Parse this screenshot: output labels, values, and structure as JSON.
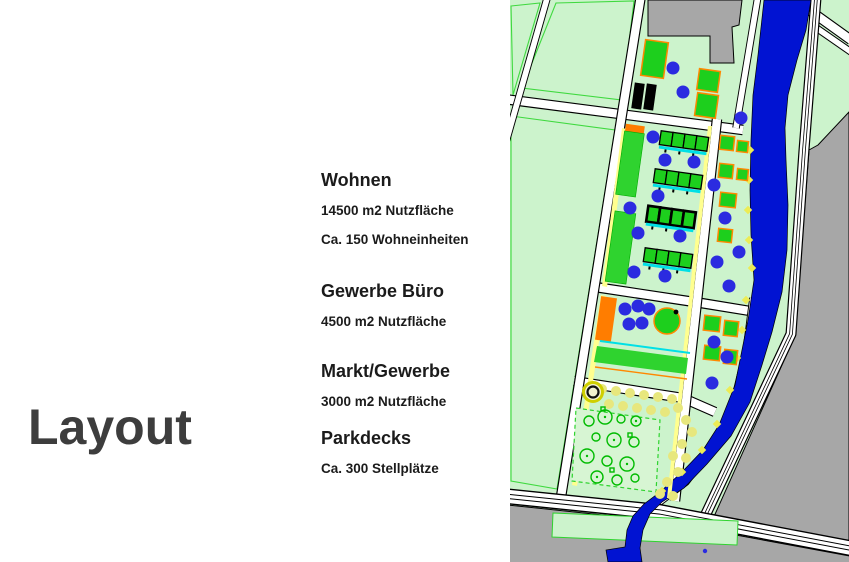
{
  "slide": {
    "title": "Layout",
    "sections": [
      {
        "heading": "Wohnen",
        "lines": [
          "14500 m2 Nutzfläche",
          "Ca. 150 Wohneinheiten"
        ]
      },
      {
        "heading": "Gewerbe Büro",
        "lines": [
          "4500 m2 Nutzfläche"
        ]
      },
      {
        "heading": "Markt/Gewerbe",
        "lines": [
          "3000 m2 Nutzfläche"
        ]
      },
      {
        "heading": "Parkdecks",
        "lines": [
          "Ca. 300 Stellplätze"
        ]
      }
    ]
  },
  "map": {
    "label": "Site plan drawing",
    "colors": {
      "parcel": "#ccf3cc",
      "parkfill": "#d7f5d3",
      "building": "#1dcf1d",
      "buildingOutline": "#ff8800",
      "orange": "#ff7d00",
      "river": "#0113d2",
      "tree": "#2b2be0",
      "gray": "#a7a7a7",
      "yellow": "#ffff8f",
      "polka": "#e7e77d",
      "cyan": "#00e0e6",
      "parkTree": "#00bb00"
    }
  }
}
